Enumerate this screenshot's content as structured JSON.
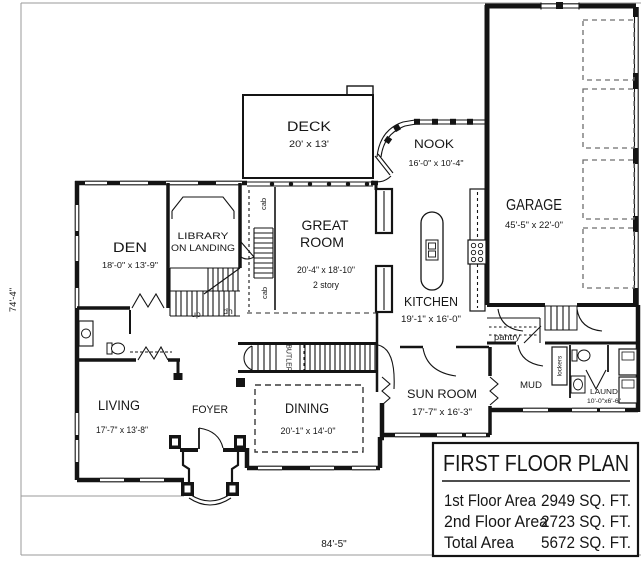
{
  "sheet": {
    "overall_width_dim": "84'-5\"",
    "overall_height_dim": "74'-4\""
  },
  "rooms": {
    "deck": {
      "name": "DECK",
      "size": "20' x 13'"
    },
    "nook": {
      "name": "NOOK",
      "size": "16'-0\" x 10'-4\""
    },
    "garage": {
      "name": "GARAGE",
      "size": "45'-5\" x 22'-0\""
    },
    "den": {
      "name": "DEN",
      "size": "18'-0\" x 13'-9\""
    },
    "library": {
      "name_line1": "LIBRARY",
      "name_line2": "ON LANDING"
    },
    "great_room": {
      "name_line1": "GREAT",
      "name_line2": "ROOM",
      "size": "20'-4\" x 18'-10\"",
      "note": "2 story"
    },
    "kitchen": {
      "name": "KITCHEN",
      "size": "19'-1\" x 16'-0\""
    },
    "living": {
      "name": "LIVING",
      "size": "17'-7\" x 13'-8\""
    },
    "foyer": {
      "name": "FOYER"
    },
    "dining": {
      "name": "DINING",
      "size": "20'-1\" x 14'-0\""
    },
    "sun_room": {
      "name": "SUN ROOM",
      "size": "17'-7\" x 16'-3\""
    },
    "mud": {
      "name": "MUD"
    },
    "laundry": {
      "name": "LAUND",
      "size": "10'-0\"x6'-6\""
    },
    "pantry": {
      "name": "pantry"
    }
  },
  "annotations": {
    "up": "up",
    "dn": "dn",
    "cab_upper": "cab",
    "cab_lower": "cab",
    "butler": "BUTLER",
    "lockers": "lockers"
  },
  "title_block": {
    "title": "FIRST FLOOR PLAN",
    "rows": [
      {
        "label": "1st Floor Area",
        "value": "2949 SQ. FT."
      },
      {
        "label": "2nd Floor Area",
        "value": "2723 SQ. FT."
      },
      {
        "label": "Total Area",
        "value": "5672 SQ. FT."
      }
    ]
  },
  "colors": {
    "ink": "#141414",
    "paper": "#ffffff",
    "sheet_line": "#9a9a9a"
  }
}
